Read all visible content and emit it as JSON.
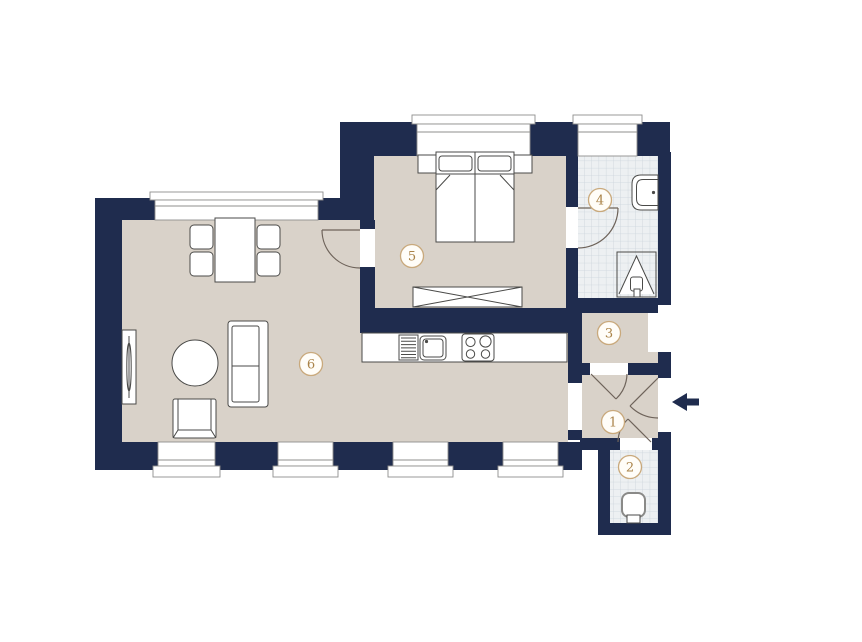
{
  "floorplan": {
    "room_labels": [
      "1",
      "2",
      "3",
      "4",
      "5",
      "6"
    ],
    "colors": {
      "wall": "#1f2c4e",
      "floor": "#d9d2c9",
      "tile": "#edf0f2",
      "tile_line": "#cbd4db",
      "frame": "#8f8f8d",
      "furn": "#4a4a48",
      "door": "#6e635a",
      "ring": "#c9a97c",
      "ringfill": "#fffdf8",
      "labeltxt": "#aa8348",
      "bg": "#ffffff"
    }
  }
}
